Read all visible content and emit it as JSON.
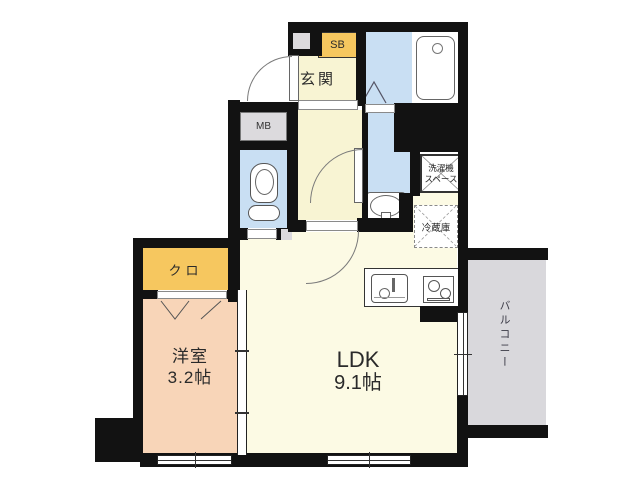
{
  "plan_title": "1K floor plan",
  "labels": {
    "genkan": "玄関",
    "shoe_box": "SB",
    "meter_box": "MB",
    "washing_machine_line1": "洗濯機",
    "washing_machine_line2": "スペース",
    "refrigerator": "冷蔵庫",
    "ldk_name": "LDK",
    "ldk_size": "9.1帖",
    "western_room_name": "洋室",
    "western_room_size": "3.2帖",
    "closet": "クロ",
    "balcony": "バルコニー"
  },
  "colors": {
    "wall": "#121212",
    "floor_yellow": "#F8F4D3",
    "floor_cream": "#FCFAE4",
    "floor_blue": "#C9DFF3",
    "floor_pink": "#F8D5B8",
    "floor_gray": "#D9D8DC",
    "box_orange": "#F6C75F",
    "box_gray": "#DCDADD",
    "line": "#666666"
  }
}
